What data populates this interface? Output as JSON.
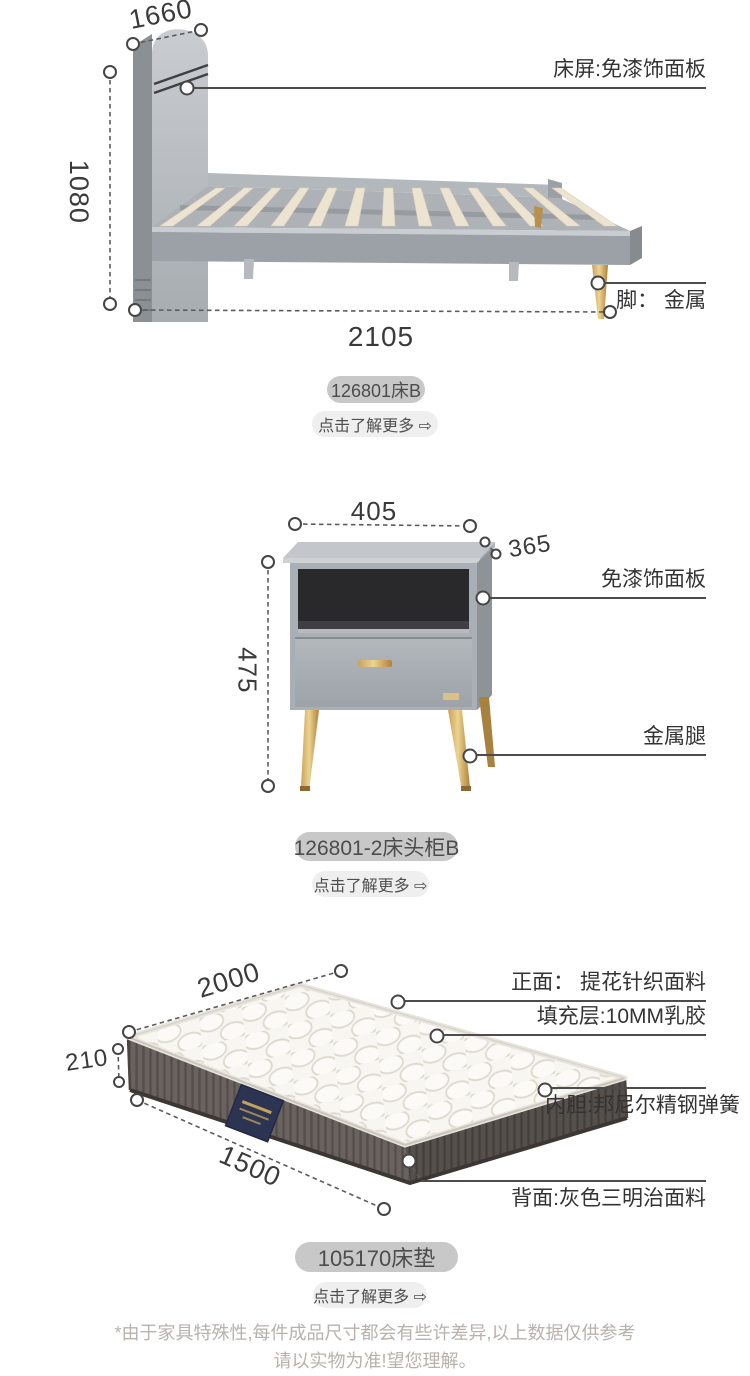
{
  "page": {
    "disclaimer_line1": "*由于家具特殊性,每件成品尺寸都会有些许差异,以上数据仅供参考",
    "disclaimer_line2": "请以实物为准!望您理解。"
  },
  "colors": {
    "gold": "#c9a45e",
    "furniture_gray": "#aab0b5",
    "annotation_line": "#4c4c4c",
    "badge_bg": "#c8c8c8",
    "more_bg": "#efefef",
    "navy_label": "#2d3452",
    "disclaimer_text": "#b8b1ad"
  },
  "bed": {
    "badge_label": "126801床B",
    "more_label": "点击了解更多 ⇨",
    "dim_width": "1660",
    "dim_height": "1080",
    "dim_length": "2105",
    "note_panel": "床屏:免漆饰面板",
    "note_feet": "脚： 金属"
  },
  "nightstand": {
    "badge_label": "126801-2床头柜B",
    "more_label": "点击了解更多 ⇨",
    "dim_width": "405",
    "dim_depth": "365",
    "dim_height": "475",
    "note_panel": "免漆饰面板",
    "note_legs": "金属腿"
  },
  "mattress": {
    "badge_label": "105170床垫",
    "more_label": "点击了解更多 ⇨",
    "dim_length": "2000",
    "dim_height": "210",
    "dim_width": "1500",
    "note_front": "正面： 提花针织面料",
    "note_filling": "填充层:10MM乳胶",
    "note_core": "内胆:邦尼尔精钢弹簧",
    "note_back": "背面:灰色三明治面料"
  }
}
